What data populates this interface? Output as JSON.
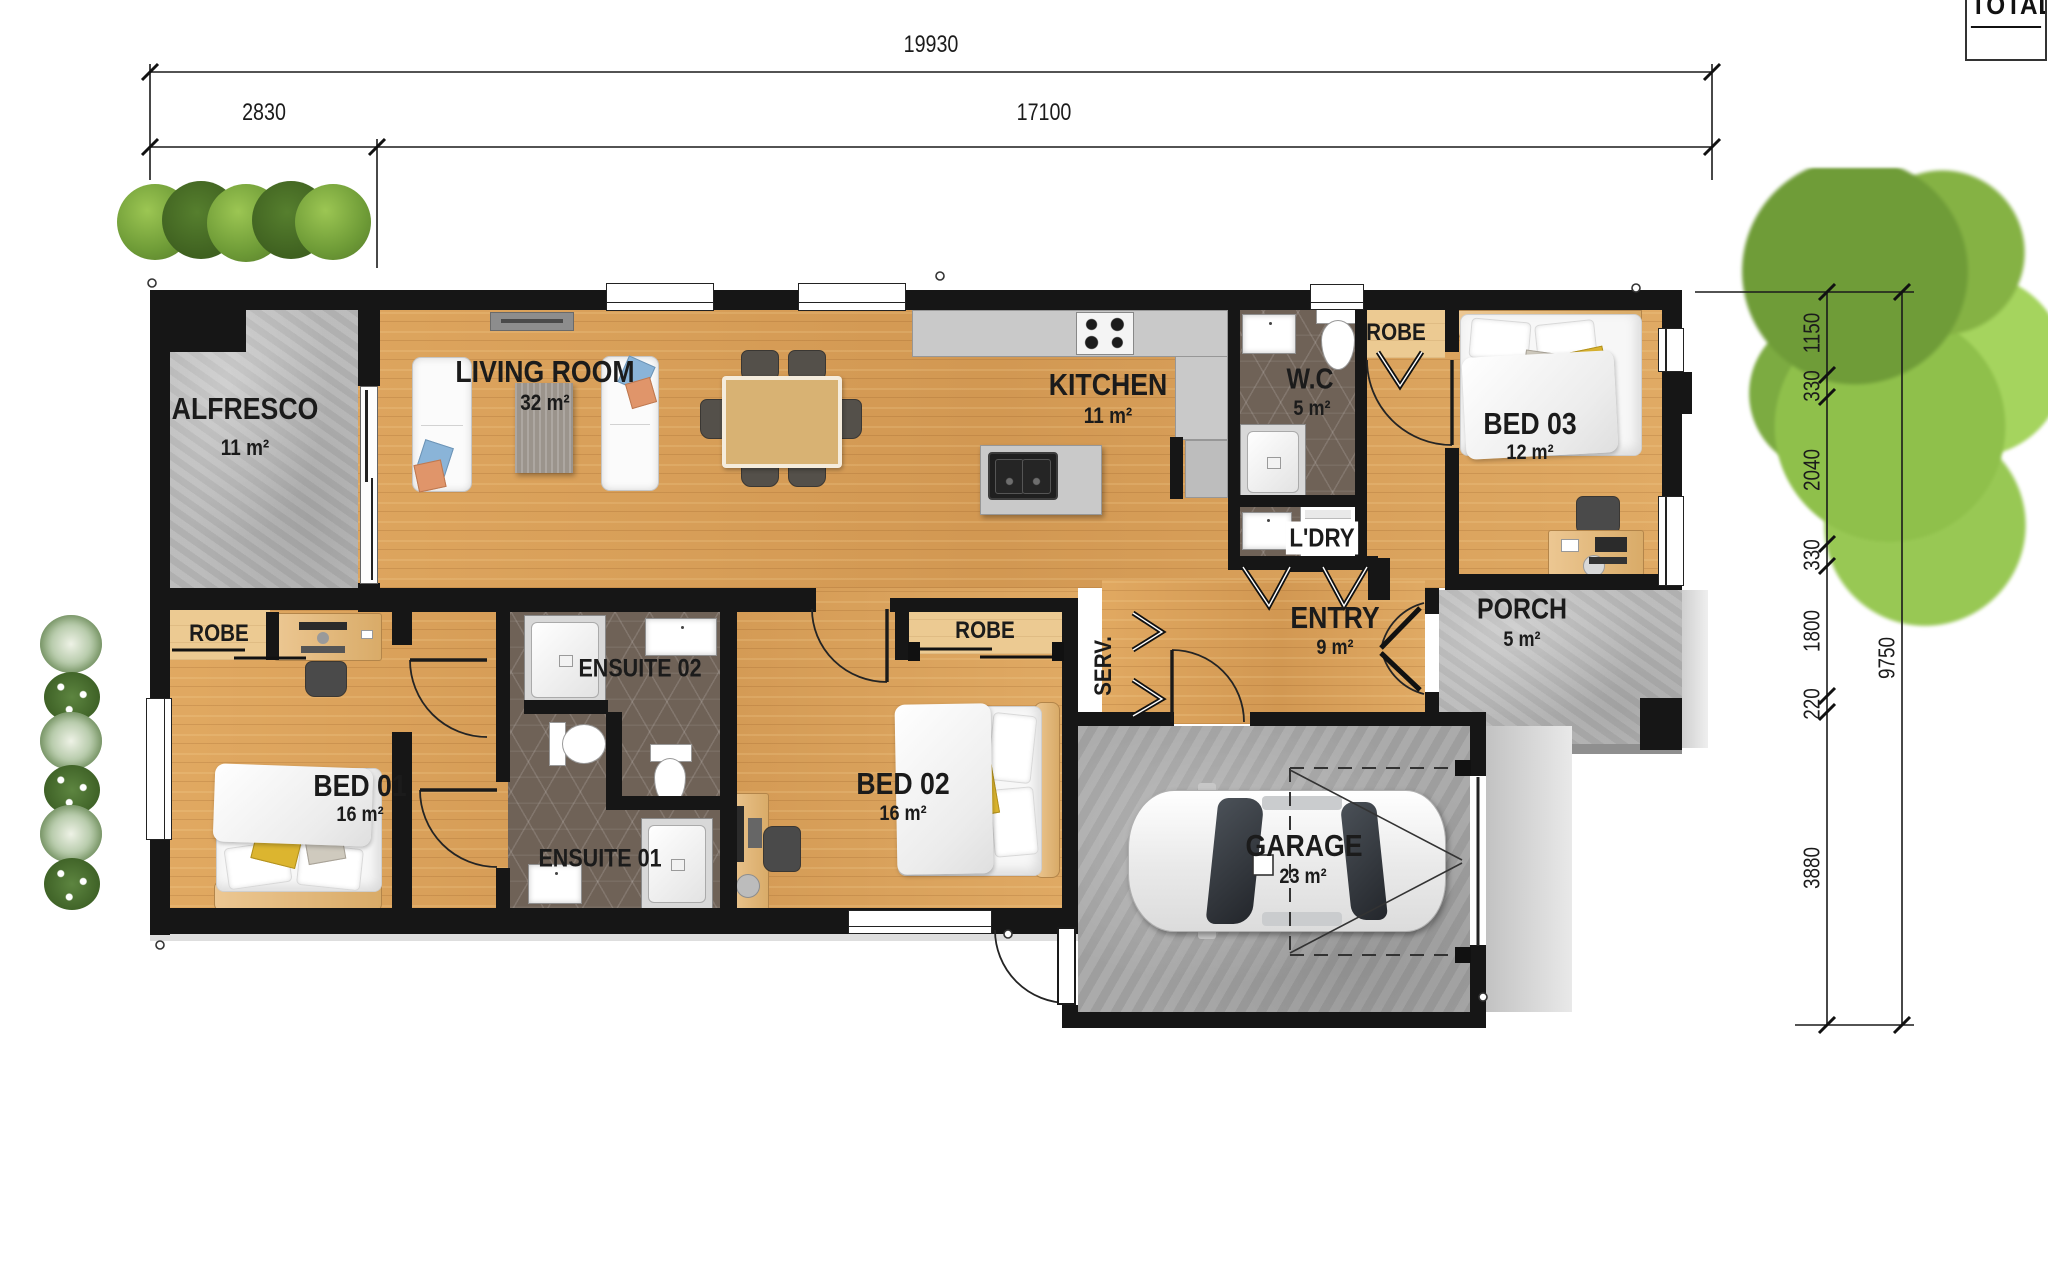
{
  "title_block": {
    "label": "TOTAL"
  },
  "dims": {
    "total_width": "19930",
    "left_width": "2830",
    "right_width": "17100",
    "r1150": "1150",
    "r330a": "330",
    "r2040": "2040",
    "r330b": "330",
    "r1800": "1800",
    "r220": "220",
    "r3880": "3880",
    "r9750": "9750"
  },
  "rooms": {
    "alfresco": {
      "name": "ALFRESCO",
      "area": "11 m²"
    },
    "living": {
      "name": "LIVING ROOM",
      "area": "32 m²"
    },
    "kitchen": {
      "name": "KITCHEN",
      "area": "11 m²"
    },
    "wc": {
      "name": "W.C",
      "area": "5 m²"
    },
    "bed3": {
      "name": "BED 03",
      "area": "12 m²"
    },
    "entry": {
      "name": "ENTRY",
      "area": "9 m²"
    },
    "porch": {
      "name": "PORCH",
      "area": "5 m²"
    },
    "bed1": {
      "name": "BED 01",
      "area": "16 m²"
    },
    "bed2": {
      "name": "BED 02",
      "area": "16 m²"
    },
    "garage": {
      "name": "GARAGE",
      "area": "23 m²"
    },
    "ens1": {
      "name": "ENSUITE 01"
    },
    "ens2": {
      "name": "ENSUITE 02"
    },
    "ldry": {
      "name": "L'DRY"
    },
    "serv": {
      "name": "SERV."
    },
    "robe_bed1": {
      "name": "ROBE"
    },
    "robe_bed2": {
      "name": "ROBE"
    },
    "robe_bed3": {
      "name": "ROBE"
    }
  },
  "colors": {
    "wall": "#161616",
    "wood_floor": "#d8a15b",
    "concrete": "#b9b9b9",
    "bath_tile": "#6f6257",
    "accent_pillow": "#dcb52f",
    "foliage": "#7fae3f"
  }
}
